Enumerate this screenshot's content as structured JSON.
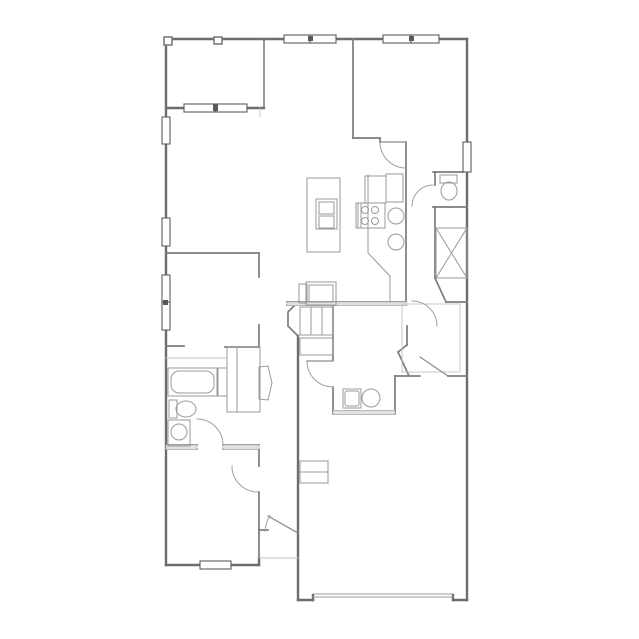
{
  "meta": {
    "title": "Residential floor plan (unlabeled line drawing)"
  },
  "canvas": {
    "width": 639,
    "height": 639,
    "background": "#ffffff"
  },
  "plan": {
    "groups": [
      {
        "name": "exterior-walls",
        "stroke": "#6d6d6d",
        "width": 2.4,
        "fill": "none",
        "lines": [
          [
            166,
            39,
            467,
            39
          ],
          [
            166,
            39,
            166,
            565
          ],
          [
            166,
            565,
            259,
            565
          ],
          [
            259,
            558,
            259,
            565
          ],
          [
            298,
            336,
            298,
            600
          ],
          [
            298,
            600,
            313,
            600
          ],
          [
            313,
            595,
            313,
            600
          ],
          [
            453,
            595,
            453,
            600
          ],
          [
            453,
            600,
            467,
            600
          ],
          [
            467,
            39,
            467,
            600
          ],
          [
            166,
            108,
            264,
            108
          ]
        ]
      },
      {
        "name": "patio-walls",
        "stroke": "#7c7c7c",
        "width": 1.6,
        "fill": "#ffffff",
        "lines": [
          [
            264,
            39,
            264,
            108
          ]
        ],
        "rects": [
          [
            164,
            37,
            8,
            8
          ],
          [
            214,
            37,
            8,
            7
          ]
        ]
      },
      {
        "name": "interior-walls",
        "stroke": "#7d7d7d",
        "width": 1.7,
        "fill": "none",
        "lines": [
          [
            166,
            253,
            259,
            253
          ],
          [
            259,
            253,
            259,
            277
          ],
          [
            259,
            325,
            259,
            347
          ],
          [
            166,
            346,
            184,
            346
          ],
          [
            225,
            347,
            259,
            347
          ],
          [
            166,
            445,
            197,
            445
          ],
          [
            223,
            445,
            259,
            445
          ],
          [
            166,
            449,
            197,
            449
          ],
          [
            223,
            449,
            259,
            449
          ],
          [
            259,
            450,
            259,
            466
          ],
          [
            259,
            492,
            259,
            533
          ],
          [
            259,
            530,
            268,
            530
          ],
          [
            259,
            533,
            259,
            558
          ],
          [
            353,
            39,
            353,
            138
          ],
          [
            353,
            138,
            380,
            138
          ],
          [
            380,
            138,
            380,
            142
          ],
          [
            406,
            142,
            406,
            302
          ],
          [
            435,
            172,
            435,
            185
          ],
          [
            433,
            172,
            463,
            172
          ],
          [
            435,
            207,
            435,
            278
          ],
          [
            435,
            278,
            446,
            302
          ],
          [
            446,
            302,
            467,
            302
          ],
          [
            433,
            207,
            467,
            207
          ],
          [
            287,
            302,
            406,
            302
          ],
          [
            287,
            305,
            406,
            305
          ],
          [
            333,
            305,
            333,
            360
          ],
          [
            333,
            387,
            333,
            413
          ],
          [
            395,
            376,
            395,
            413
          ],
          [
            333,
            411,
            395,
            411
          ],
          [
            333,
            414,
            395,
            414
          ],
          [
            395,
            376,
            420,
            376
          ],
          [
            448,
            376,
            467,
            376
          ],
          [
            398,
            352,
            409,
            376
          ],
          [
            407,
            326,
            407,
            345
          ],
          [
            407,
            345,
            398,
            352
          ]
        ],
        "polylines": [
          [
            [
              298,
              302
            ],
            [
              288,
              312
            ],
            [
              288,
              326
            ],
            [
              298,
              336
            ]
          ]
        ]
      },
      {
        "name": "wall-fill-bands",
        "stroke": "#b5b5b5",
        "width": 0.6,
        "fill": "#e2e2e2",
        "rects": [
          [
            287,
            302,
            120,
            3.5
          ],
          [
            333,
            410.5,
            62,
            4
          ],
          [
            166,
            445,
            31,
            4.5
          ],
          [
            223,
            445,
            36,
            4.5
          ]
        ]
      },
      {
        "name": "floor-edge-lines",
        "stroke": "#c2c2c2",
        "width": 0.9,
        "fill": "none",
        "lines": [
          [
            259,
            558,
            298,
            558
          ],
          [
            166,
            358,
            227,
            358
          ],
          [
            260,
            108,
            260,
            117
          ]
        ],
        "rects": [
          [
            402,
            304,
            58,
            68
          ]
        ]
      },
      {
        "name": "windows",
        "stroke": "#5e5e5e",
        "width": 1.1,
        "fill": "#ffffff",
        "rects": [
          [
            184,
            104,
            31,
            8
          ],
          [
            216,
            104,
            31,
            8
          ],
          [
            284,
            35,
            26,
            8
          ],
          [
            310,
            35,
            26,
            8
          ],
          [
            383,
            35,
            28,
            8
          ],
          [
            411,
            35,
            28,
            8
          ],
          [
            162,
            117,
            8,
            27
          ],
          [
            162,
            218,
            8,
            28
          ],
          [
            162,
            275,
            8,
            28
          ],
          [
            162,
            302,
            8,
            28
          ],
          [
            463,
            142,
            8,
            30
          ],
          [
            200,
            561,
            31,
            8
          ]
        ]
      },
      {
        "name": "window-mullions",
        "stroke": "none",
        "width": 0,
        "fill": "#5a5a5a",
        "rects": [
          [
            308,
            36,
            5,
            5
          ],
          [
            409,
            36,
            5,
            5
          ],
          [
            163,
            300,
            5,
            5
          ],
          [
            213,
            104,
            5,
            7
          ]
        ]
      },
      {
        "name": "door-swing-arcs",
        "stroke": "#a0a0a0",
        "width": 1,
        "fill": "none",
        "arcs": [
          [
            197,
            445,
            26,
            270,
            360
          ],
          [
            258,
            466,
            26,
            90,
            180
          ],
          [
            333,
            361,
            26,
            90,
            180
          ],
          [
            406,
            142,
            26,
            90,
            180
          ],
          [
            433,
            206,
            21,
            180,
            270
          ],
          [
            412,
            326,
            25,
            270,
            360
          ],
          [
            298,
            533,
            33,
            183,
            212
          ]
        ]
      },
      {
        "name": "door-leaves",
        "stroke": "#8a8a8a",
        "width": 1.2,
        "fill": "none",
        "lines": [
          [
            333,
            361,
            307,
            361
          ],
          [
            420,
            357,
            448,
            376
          ],
          [
            268,
            516,
            298,
            533
          ],
          [
            406,
            142,
            380,
            142
          ]
        ]
      },
      {
        "name": "kitchen-fixtures",
        "stroke": "#9a9a9a",
        "width": 1,
        "fill": "none",
        "lines": [
          [
            368,
            175,
            368,
            253
          ],
          [
            368,
            253,
            390,
            276
          ],
          [
            390,
            276,
            390,
            302
          ],
          [
            358,
            203,
            358,
            228
          ],
          [
            361,
            203,
            361,
            228
          ]
        ],
        "rects": [
          [
            365,
            176,
            21,
            27
          ],
          [
            386,
            174,
            17,
            28
          ],
          [
            356,
            203,
            29,
            25
          ],
          [
            307,
            178,
            33,
            74
          ],
          [
            316,
            199,
            21,
            30
          ],
          [
            319,
            202,
            15,
            12
          ],
          [
            319,
            216,
            15,
            12
          ],
          [
            306,
            282,
            30,
            23
          ],
          [
            309,
            285,
            24,
            17
          ],
          [
            299,
            284,
            8,
            19
          ]
        ],
        "circles": [
          [
            365,
            210,
            3.5
          ],
          [
            375,
            210,
            3.5
          ],
          [
            365,
            221,
            3.5
          ],
          [
            375,
            221,
            3.5
          ],
          [
            396,
            216,
            8
          ],
          [
            396,
            242,
            8
          ]
        ]
      },
      {
        "name": "bathroom-fixtures",
        "stroke": "#9a9a9a",
        "width": 1,
        "fill": "none",
        "rects": [
          [
            168,
            368,
            50,
            28
          ],
          [
            171,
            371,
            43,
            22,
            8
          ],
          [
            217,
            368,
            10,
            28
          ],
          [
            169,
            400,
            8,
            18
          ],
          [
            168,
            420,
            22,
            26
          ]
        ],
        "circles": [
          [
            179,
            432,
            8
          ]
        ],
        "ellipses": [
          [
            186,
            409,
            10,
            8
          ]
        ]
      },
      {
        "name": "powder-room-fixtures",
        "stroke": "#9a9a9a",
        "width": 1,
        "fill": "none",
        "rects": [
          [
            440,
            175,
            17,
            8
          ]
        ],
        "ellipses": [
          [
            449,
            191,
            8,
            9
          ]
        ]
      },
      {
        "name": "utility-closet",
        "stroke": "#9a9a9a",
        "width": 1,
        "fill": "none",
        "rects": [
          [
            436,
            228,
            31,
            50
          ]
        ],
        "lines": [
          [
            436,
            228,
            467,
            278
          ],
          [
            436,
            278,
            467,
            228
          ]
        ]
      },
      {
        "name": "laundry-fixtures",
        "stroke": "#9a9a9a",
        "width": 1,
        "fill": "none",
        "rects": [
          [
            343,
            389,
            18,
            19
          ],
          [
            345,
            391,
            14,
            15,
            2
          ]
        ],
        "circles": [
          [
            371,
            398,
            9
          ]
        ]
      },
      {
        "name": "hall-closet-fixtures",
        "stroke": "#9a9a9a",
        "width": 1,
        "fill": "none",
        "rects": [
          [
            227,
            347,
            33,
            65
          ],
          [
            300,
            307,
            33,
            28
          ],
          [
            300,
            338,
            33,
            17
          ]
        ],
        "lines": [
          [
            237,
            347,
            237,
            412
          ],
          [
            311,
            307,
            311,
            335
          ],
          [
            322,
            307,
            322,
            335
          ]
        ],
        "polygons": [
          [
            [
              259,
              367
            ],
            [
              268,
              366
            ],
            [
              272,
              383
            ],
            [
              268,
              400
            ],
            [
              259,
              399
            ]
          ]
        ]
      },
      {
        "name": "garage-fixtures",
        "stroke": "#9a9a9a",
        "width": 1,
        "fill": "none",
        "lines": [
          [
            313,
            594,
            453,
            594
          ],
          [
            313,
            597,
            453,
            597
          ]
        ],
        "rects": [
          [
            300,
            461,
            28,
            11
          ],
          [
            300,
            472,
            28,
            11
          ]
        ]
      }
    ]
  }
}
